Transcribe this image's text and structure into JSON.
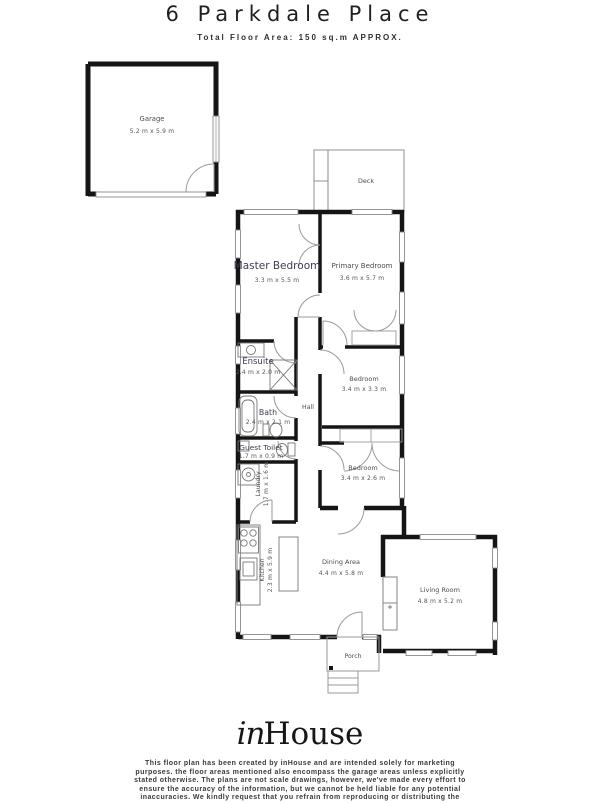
{
  "header": {
    "title": "6 Parkdale Place",
    "subtitle": "Total Floor Area: 150 sq.m APPROX."
  },
  "rooms": [
    {
      "name": "Garage",
      "dims": "5.2 m x 5.9 m"
    },
    {
      "name": "Deck",
      "dims": ""
    },
    {
      "name": "Master Bedroom",
      "dims": "3.3 m x 5.5 m"
    },
    {
      "name": "Primary Bedroom",
      "dims": "3.6 m x 5.7 m"
    },
    {
      "name": "Ensuite",
      "dims": "2.4 m x 2.0 m"
    },
    {
      "name": "Bedroom",
      "dims": "3.4 m x 3.3 m"
    },
    {
      "name": "Bath",
      "dims": "2.4 m x 2.1 m"
    },
    {
      "name": "Hall",
      "dims": ""
    },
    {
      "name": "Guest Toilet",
      "dims": "1.7 m x 0.9 m"
    },
    {
      "name": "Bedroom",
      "dims": "3.4 m x 2.6 m"
    },
    {
      "name": "Laundry",
      "dims": "1.7 m x 1.6 m"
    },
    {
      "name": "Kitchen",
      "dims": "2.3 m x 5.9 m"
    },
    {
      "name": "Dining Area",
      "dims": "4.4 m x 5.8 m"
    },
    {
      "name": "Living Room",
      "dims": "4.8 m x 5.2 m"
    },
    {
      "name": "Porch",
      "dims": ""
    }
  ],
  "footer": {
    "logo": {
      "script_part": "in",
      "serif_part": "House"
    },
    "disclaimer_lines": [
      "This floor plan has been created by inHouse and are intended solely for marketing",
      "purposes. the floor areas mentioned also encompass the garage areas unless explicitly",
      "stated otherwise. The plans are not scale drawings, however, we've made every effort to",
      "ensure the accuracy of the information, but we cannot be held liable for any potential",
      "inaccuracies. We kindly request that you refrain from reproducing or distributing the"
    ]
  },
  "colors": {
    "wall": "#151515",
    "thin_line": "#8a8a8a",
    "label": "#3d3d52"
  }
}
